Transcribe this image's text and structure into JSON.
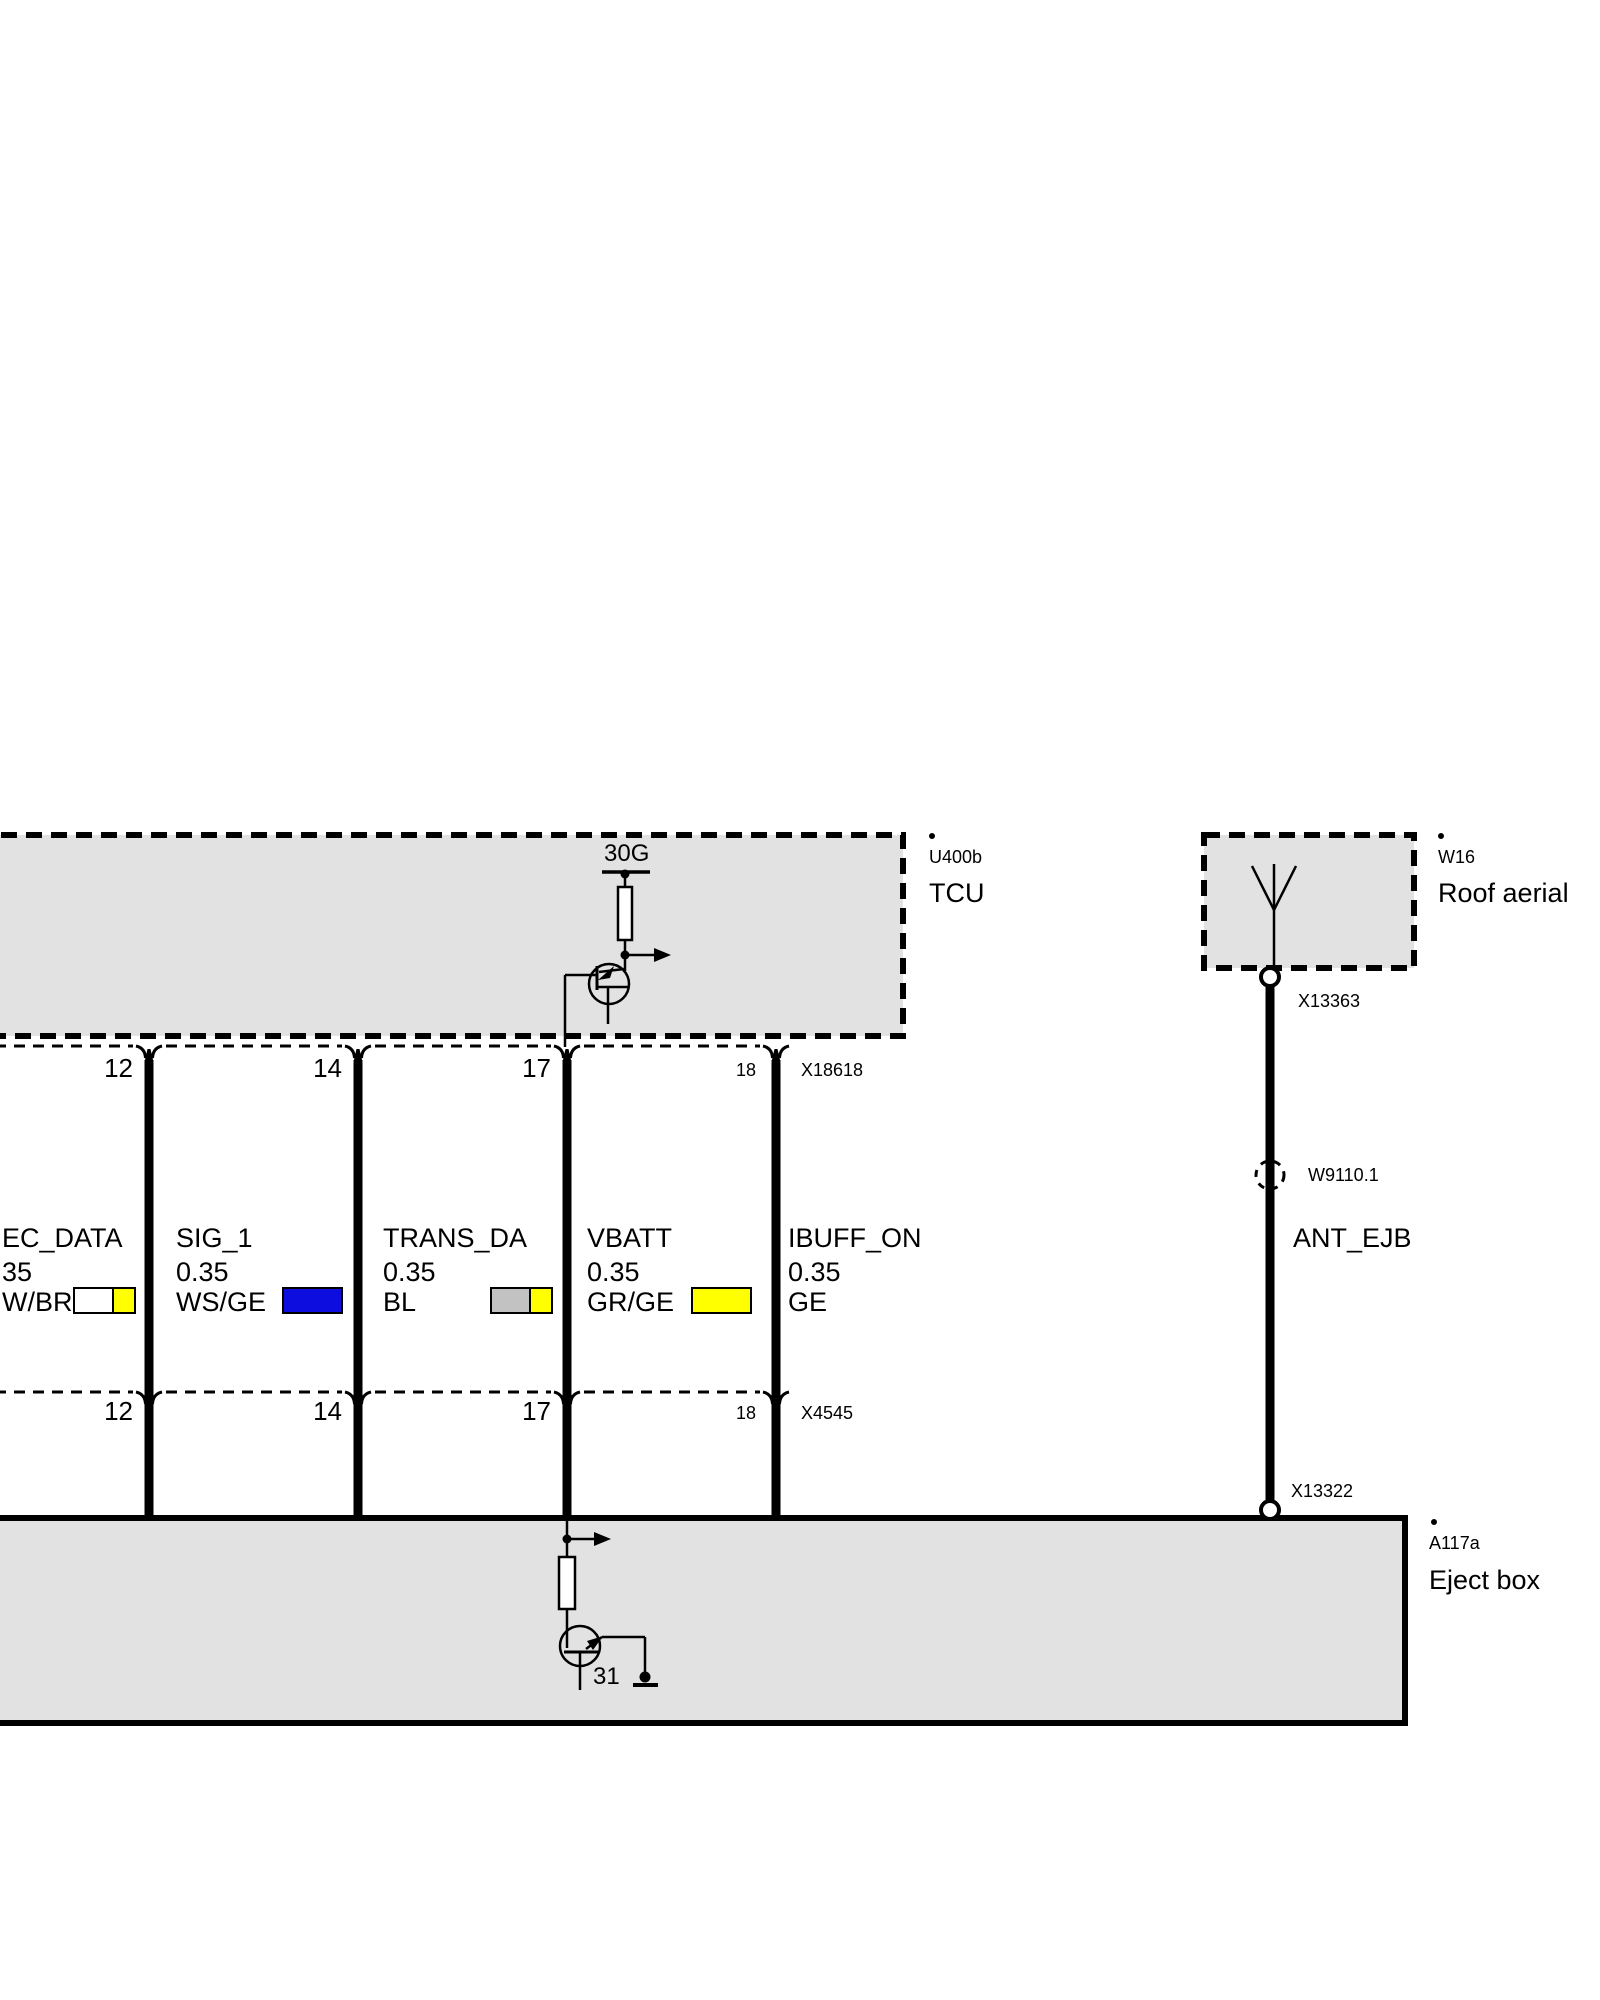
{
  "diagram": {
    "type": "automotive wiring schematic",
    "colors": {
      "box_fill": "#e2e2e2",
      "line": "#000000",
      "chip_white": "#ffffff",
      "chip_yellow": "#ffff00",
      "chip_blue": "#0d0de0",
      "chip_gray": "#c2c2c2"
    },
    "tcu": {
      "ref_dot": ".",
      "code": "U400b",
      "label": "TCU",
      "power_rail": "30G",
      "connector": {
        "id": "X18618",
        "pins": [
          "12",
          "14",
          "17",
          "18"
        ]
      }
    },
    "roof_aerial": {
      "ref_dot": ".",
      "code": "W16",
      "label": "Roof aerial",
      "connector_top": "X13363",
      "splice": "W9110.1",
      "signal": "ANT_EJB",
      "connector_bottom": "X13322"
    },
    "eject_box": {
      "ref_dot": ".",
      "code": "A117a",
      "label": "Eject box",
      "connector": {
        "id": "X4545",
        "pins": [
          "12",
          "14",
          "17",
          "18"
        ]
      },
      "ground_terminal": "31"
    },
    "wires": [
      {
        "signal": "EC_DATA",
        "gauge": "35",
        "color_code": "W/BR",
        "chip_colors": [
          "#ffffff",
          "#ffff00"
        ]
      },
      {
        "signal": "SIG_1",
        "gauge": "0.35",
        "color_code": "WS/GE",
        "chip_colors": [
          "#0d0de0"
        ]
      },
      {
        "signal": "TRANS_DA",
        "gauge": "0.35",
        "color_code": "BL",
        "chip_colors": [
          "#c2c2c2",
          "#ffff00"
        ]
      },
      {
        "signal": "VBATT",
        "gauge": "0.35",
        "color_code": "GR/GE",
        "chip_colors": [
          "#ffff00"
        ]
      },
      {
        "signal": "IBUFF_ON",
        "gauge": "0.35",
        "color_code": "GE",
        "chip_colors": []
      }
    ]
  }
}
